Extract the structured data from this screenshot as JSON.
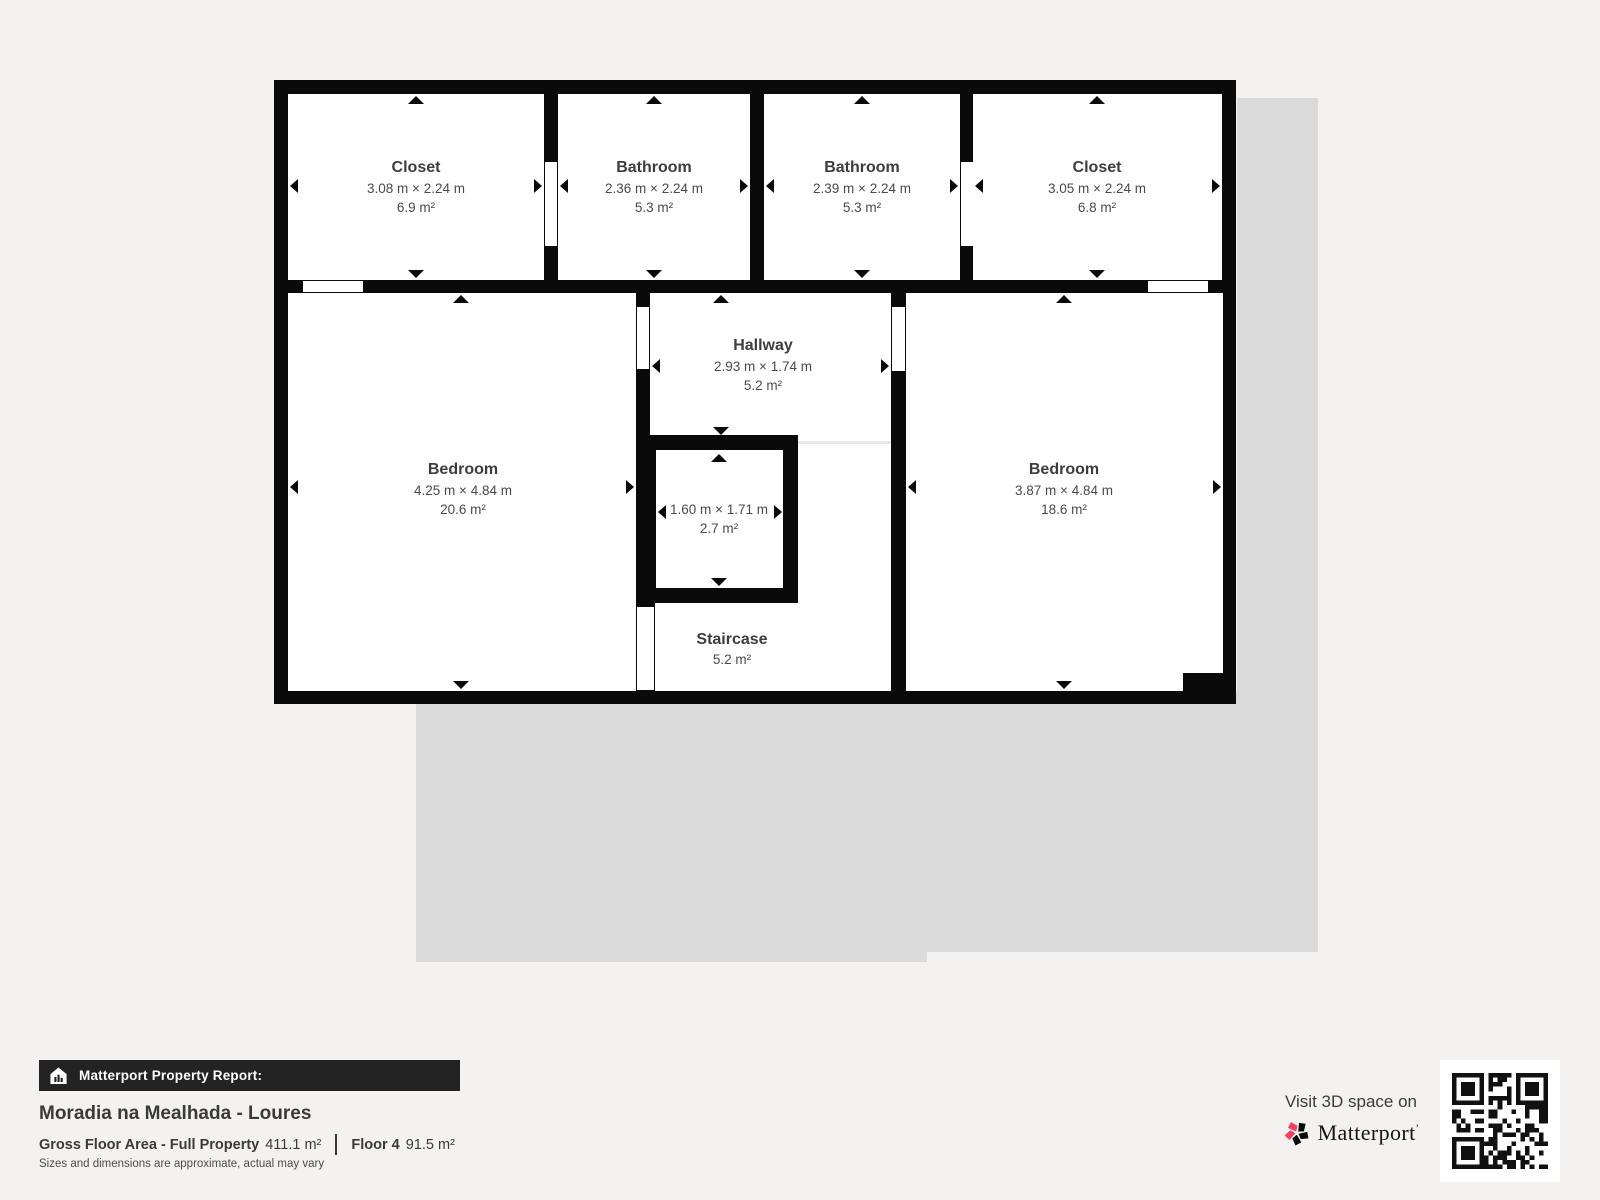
{
  "floor_plan": {
    "rooms": [
      {
        "name": "Closet",
        "dims": "3.08 m × 2.24 m",
        "area": "6.9 m²"
      },
      {
        "name": "Bathroom",
        "dims": "2.36 m × 2.24 m",
        "area": "5.3 m²"
      },
      {
        "name": "Bathroom",
        "dims": "2.39 m × 2.24 m",
        "area": "5.3 m²"
      },
      {
        "name": "Closet",
        "dims": "3.05 m × 2.24 m",
        "area": "6.8 m²"
      },
      {
        "name": "Bedroom",
        "dims": "4.25 m × 4.84 m",
        "area": "20.6 m²"
      },
      {
        "name": "Hallway",
        "dims": "2.93 m × 1.74 m",
        "area": "5.2 m²"
      },
      {
        "name": "",
        "dims": "1.60 m × 1.71 m",
        "area": "2.7 m²"
      },
      {
        "name": "Bedroom",
        "dims": "3.87 m × 4.84 m",
        "area": "18.6 m²"
      },
      {
        "name": "Staircase",
        "dims": "",
        "area": "5.2 m²"
      }
    ]
  },
  "report": {
    "banner_label": "Matterport Property Report:",
    "title": "Moradia na Mealhada - Loures",
    "gross_label": "Gross Floor Area - Full Property",
    "gross_value": "411.1 m²",
    "floor_label": "Floor 4",
    "floor_value": "91.5 m²",
    "disclaimer": "Sizes and dimensions are approximate, actual may vary"
  },
  "footer_right": {
    "visit_text": "Visit 3D space on",
    "brand": "Matterport",
    "brand_mark": "’"
  },
  "colors": {
    "background": "#f3f2f0",
    "wall_black": "#0a0a0a",
    "shadow_gray": "#dadada",
    "banner_bg": "#232323",
    "brand_pink": "#f43e5c",
    "text_dark": "#3a3a3a"
  }
}
